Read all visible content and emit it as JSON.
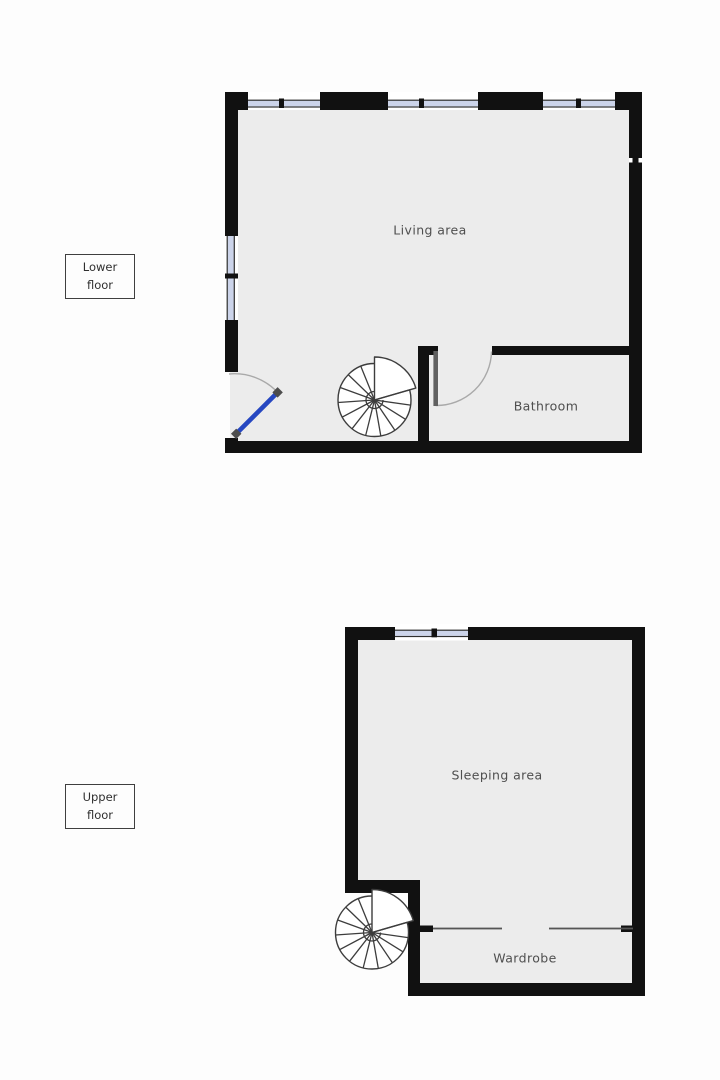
{
  "page": {
    "background": "#fdfdfd",
    "type": "floorplan"
  },
  "colors": {
    "wall": "#111111",
    "floor": "#ececec",
    "window_glass": "#ccd4ea",
    "window_line": "#2f2f2f",
    "door_accent": "#2647c1",
    "door_leaf_gray": "#606060",
    "door_cap": "#4d4d4d",
    "swing_arc": "#a9a9a9",
    "stair_line": "#3d3d3d",
    "partition_line": "#555555",
    "label_text": "#4f4f4f"
  },
  "floors": [
    {
      "tag": {
        "line1": "Lower",
        "line2": "floor"
      },
      "rooms": [
        {
          "name": "Living area"
        },
        {
          "name": "Bathroom"
        }
      ],
      "symbols": [
        "spiral-staircase",
        "entry-door",
        "bathroom-door",
        "windows"
      ]
    },
    {
      "tag": {
        "line1": "Upper",
        "line2": "floor"
      },
      "rooms": [
        {
          "name": "Sleeping area"
        },
        {
          "name": "Wardrobe"
        }
      ],
      "symbols": [
        "spiral-staircase",
        "window",
        "wardrobe-partition"
      ]
    }
  ]
}
